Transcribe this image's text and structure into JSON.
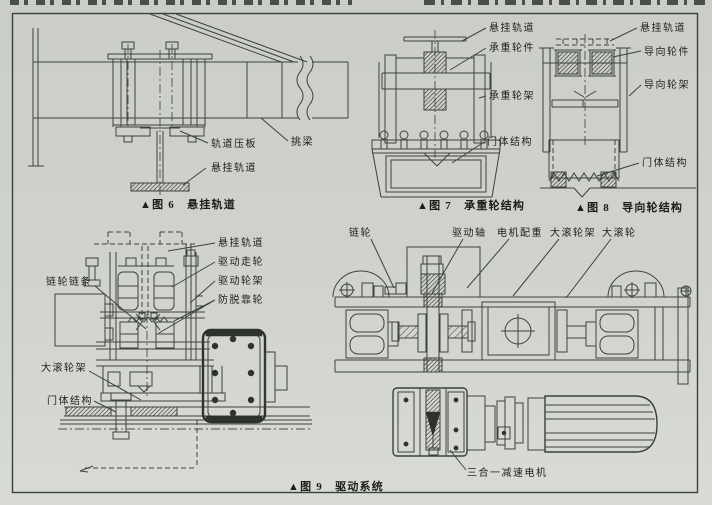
{
  "palette": {
    "paper": "#cfd3cb",
    "ink": "#3e423c",
    "text": "#20231c"
  },
  "figures": {
    "fig6": {
      "caption": "▲图 6　悬挂轨道",
      "labels": {
        "rail_clamp": "轨道压板",
        "cantilever_beam": "挑梁",
        "suspension_rail": "悬挂轨道"
      }
    },
    "fig7": {
      "caption": "▲图 7　承重轮结构",
      "labels": {
        "suspension_rail": "悬挂轨道",
        "load_wheel": "承重轮件",
        "load_wheel_frame": "承重轮架",
        "door_body": "门体结构"
      }
    },
    "fig8": {
      "caption": "▲图 8　导向轮结构",
      "labels": {
        "suspension_rail": "悬挂轨道",
        "guide_wheel": "导向轮件",
        "guide_wheel_frame": "导向轮架",
        "door_body": "门体结构"
      }
    },
    "fig9": {
      "caption": "▲图 9　驱动系统",
      "labels_left": {
        "sprocket_chain": "链轮链条",
        "suspension_rail": "悬挂轨道",
        "drive_wheel": "驱动走轮",
        "drive_wheel_frame": "驱动轮架",
        "anti_derail_wheel": "防脱靠轮",
        "big_roller_frame": "大滚轮架",
        "door_body": "门体结构"
      },
      "labels_right": {
        "sprocket": "链轮",
        "drive_shaft": "驱动轴",
        "motor_counterweight": "电机配重",
        "big_roller_frame": "大滚轮架",
        "big_roller": "大滚轮",
        "gear_motor": "三合一减速电机"
      }
    }
  }
}
